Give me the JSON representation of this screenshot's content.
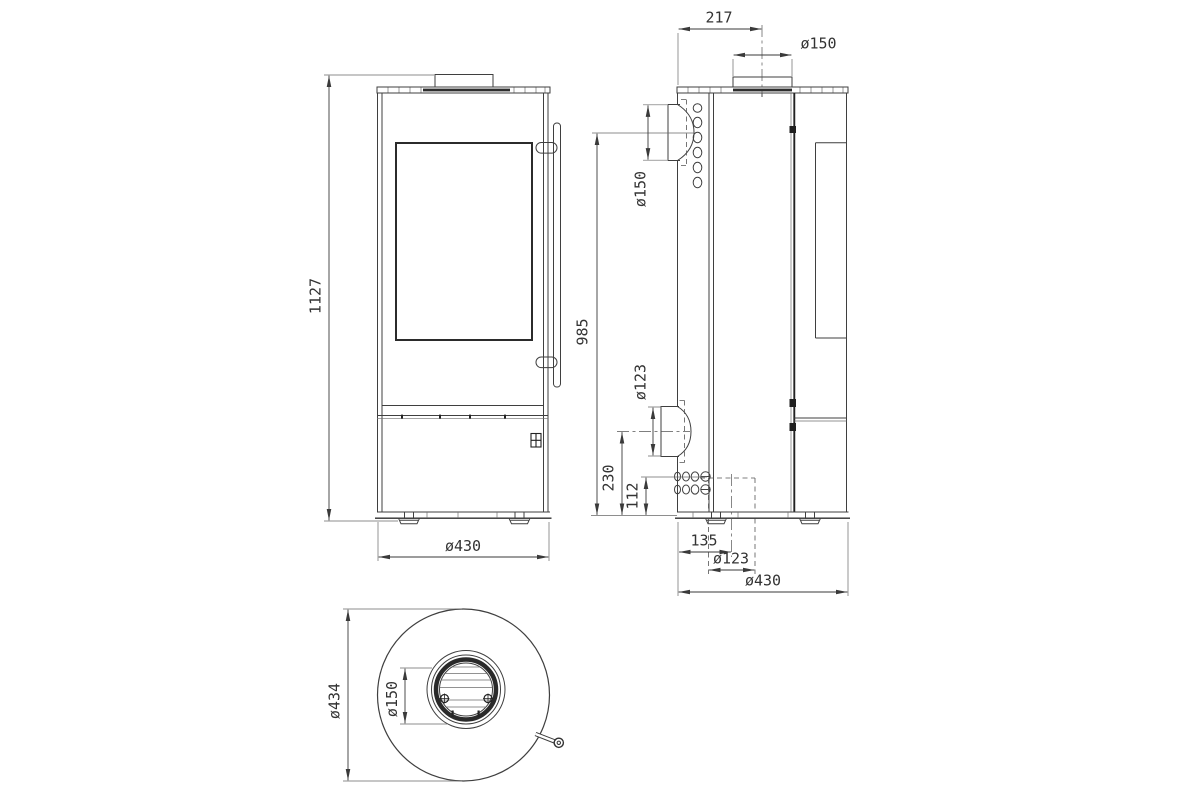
{
  "dimensions": {
    "front": {
      "overall_height": "1127",
      "base_width": "ø430"
    },
    "side": {
      "flue_center_from_rear": "217",
      "top_flue_diameter": "ø150",
      "rear_flue_center_height": "985",
      "rear_flue_diameter": "ø150",
      "rear_intake_diameter": "ø123",
      "rear_intake_center_height": "230",
      "bottom_inlet_height": "112",
      "bottom_inlet_center_from_rear": "135",
      "bottom_inlet_diameter": "ø123",
      "base_depth": "ø430"
    },
    "top": {
      "body_diameter": "ø434",
      "flue_diameter": "ø150"
    }
  }
}
